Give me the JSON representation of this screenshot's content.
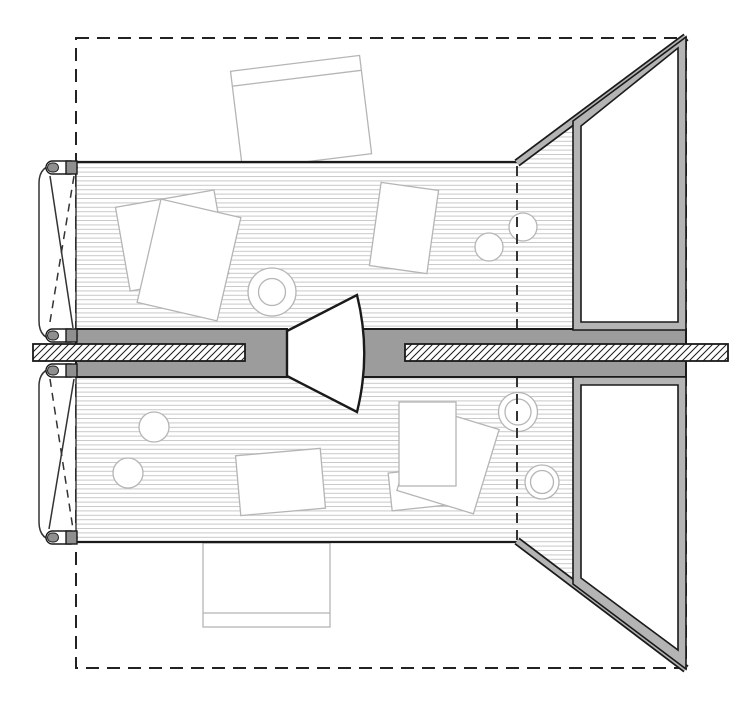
{
  "document": {
    "type": "architectural-floor-plan",
    "view": "top-down plan of a double-sided desk pavilion",
    "background": "#ffffff"
  },
  "colors": {
    "ink": "#1a1a1a",
    "line_medium": "#333333",
    "line_light": "#b5b5b5",
    "plank_line": "#c9c9c9",
    "wall_gray": "#9c9c9c",
    "panel_gray": "#b4b4b4",
    "clamp_gray": "#8f8f8f",
    "boundary_ink": "#222222",
    "paper_white": "#ffffff"
  },
  "plan": {
    "boundary": {
      "shape": "rectangle",
      "line_style": "dashed"
    },
    "spine_wall": {
      "fill": "#9c9c9c",
      "door_opening": true,
      "door_type": "double-acting pivot with swing arc"
    },
    "desk_slab_section": {
      "hatch": "diagonal",
      "bars": 2
    },
    "worktops": [
      {
        "id": "upper",
        "texture": "horizontal planks",
        "papers": 3,
        "cups": 1,
        "plain_circles": 2
      },
      {
        "id": "lower",
        "texture": "horizontal planks",
        "papers": 4,
        "cups": 2,
        "plain_circles": 2
      }
    ],
    "trestle_frames": {
      "count": 2,
      "style": "X-braced folding clamps"
    },
    "pivot_leaves": {
      "count": 2,
      "position": "right side, opened outward"
    },
    "fixed_panels": {
      "count": 2,
      "shape": "right trapezoid, thick gray frame"
    },
    "chairs": {
      "count": 2
    },
    "fold_lines": {
      "count": 2,
      "style": "dashed vertical"
    }
  }
}
